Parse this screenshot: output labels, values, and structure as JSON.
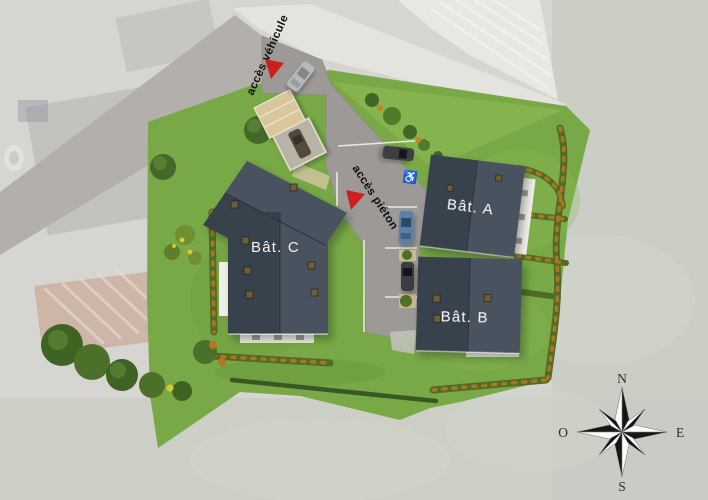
{
  "plan": {
    "access": {
      "vehicle_label": "accès véhicule",
      "pedestrian_label": "accès piéton"
    },
    "buildings": [
      {
        "id": "a",
        "label": "Bât. A"
      },
      {
        "id": "b",
        "label": "Bât. B"
      },
      {
        "id": "c",
        "label": "Bât. C"
      }
    ],
    "markers": {
      "handicap_icon": "♿"
    }
  },
  "compass": {
    "north": "N",
    "east": "E",
    "south": "S",
    "west": "O"
  },
  "colors": {
    "aerial_background": "#d6d5d1",
    "existing_road": "#b3b0ac",
    "grass": "#78a946",
    "grass_light": "#85b34e",
    "asphalt": "#9c9997",
    "roof_dark": "#39424d",
    "roof_light": "#4b5462",
    "hedge_green": "#4f6b28",
    "hedge_orange": "#b5771f",
    "marker_red": "#cc1f1f",
    "carport_beige": "#d9c69b"
  }
}
